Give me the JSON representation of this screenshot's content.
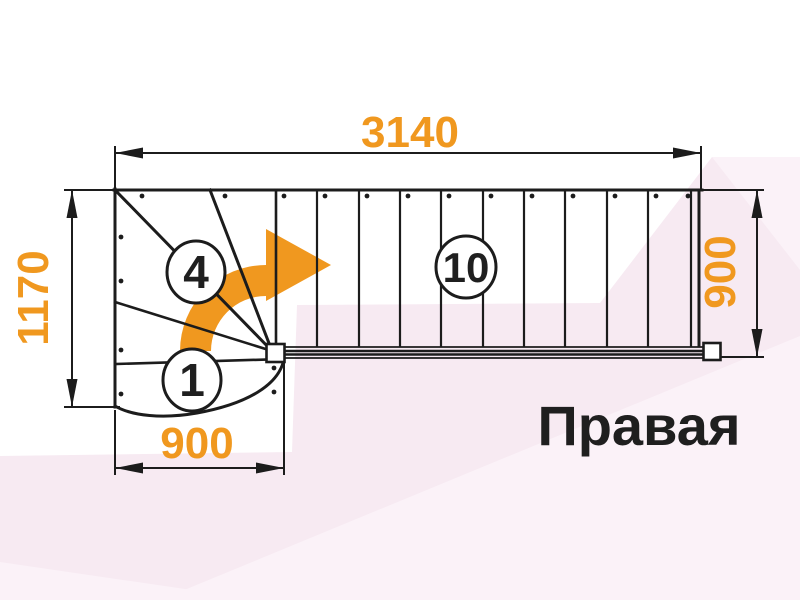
{
  "plan": {
    "orientation_label": "Правая",
    "dims": {
      "top": "3140",
      "left": "1170",
      "right": "900",
      "bottom": "900"
    },
    "steps": {
      "first": "1",
      "winder": "4",
      "straight": "10"
    }
  },
  "icons": {
    "turn_arrow": "curved-right-turn-arrow"
  },
  "colors": {
    "accent_orange": "#F0981F",
    "line_black": "#1c1c1c",
    "background_tint_pink": "#f7eaf2",
    "background_tint_pink_light": "#fbf2f8",
    "label_black": "#1f1f1f"
  }
}
